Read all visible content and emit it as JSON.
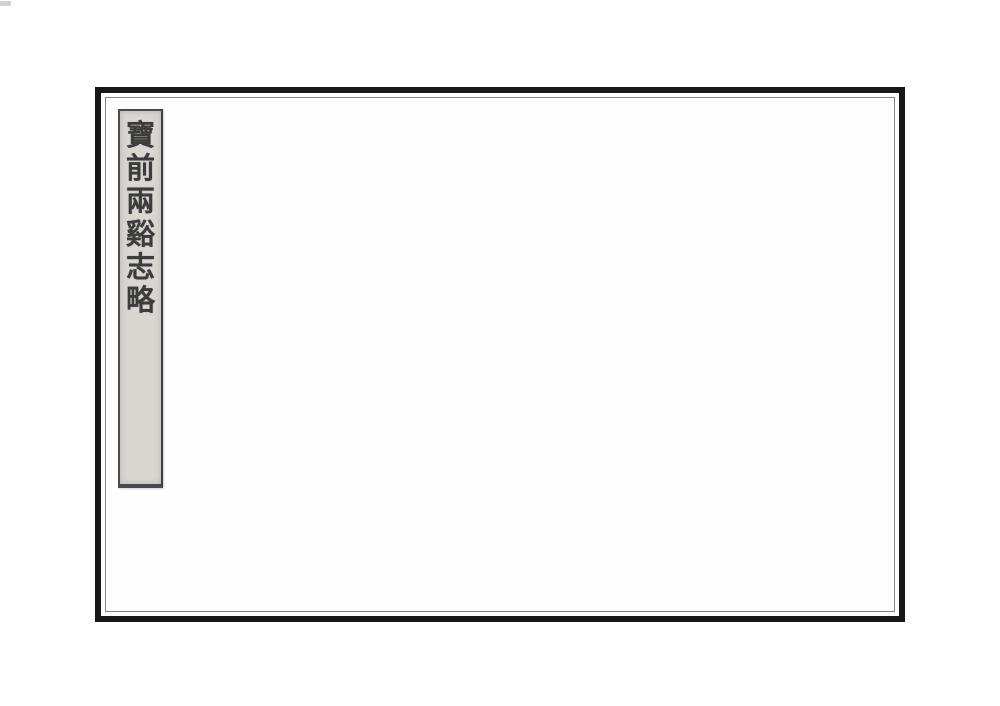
{
  "cover": {
    "kind": "scanned book cover, traditional Chinese stitched binding",
    "title_slip": {
      "title": "寶前兩谿志略",
      "reading_direction": "top-to-bottom",
      "characters": [
        "寶",
        "前",
        "兩",
        "谿",
        "志",
        "略"
      ]
    }
  },
  "colors": {
    "canvas_background": "#ffffff",
    "page_background": "#fefefe",
    "frame_border": "#171717",
    "inner_rule_line": "#848484",
    "slip_background": "#d9d7d2",
    "slip_border": "#4a4a4a",
    "ink": "#3c3c3c",
    "artifact_speck": "#c2c2c2"
  }
}
